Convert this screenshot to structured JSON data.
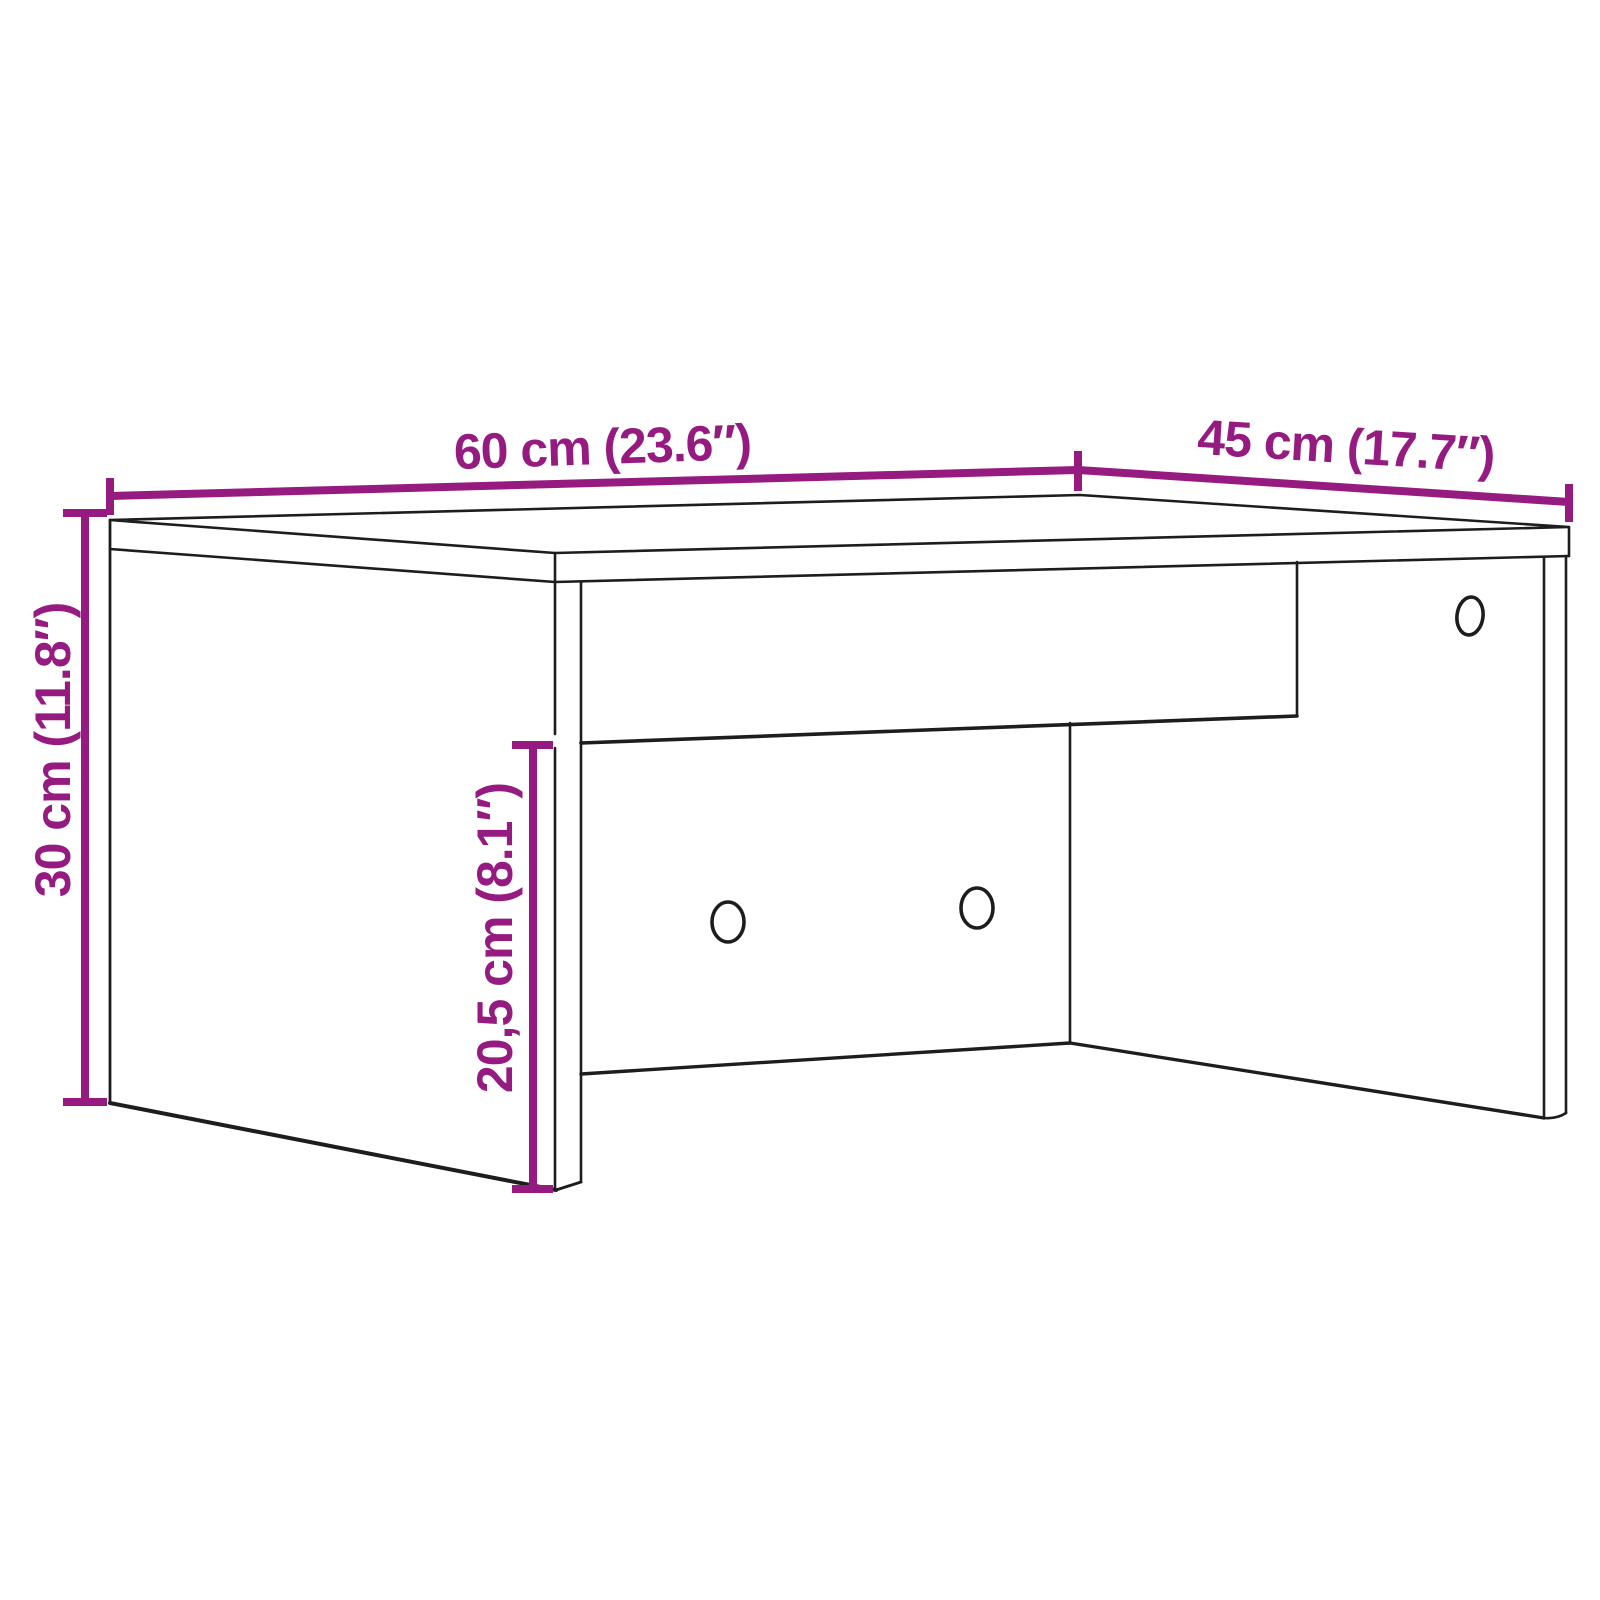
{
  "colors": {
    "dimension": "#951b81",
    "outline": "#1d1d1d",
    "background": "#ffffff"
  },
  "diagram": {
    "kind": "furniture-dimension-line-drawing",
    "dimensions": {
      "width": {
        "label": "60 cm (23.6″)",
        "value_cm": 60,
        "value_in": 23.6
      },
      "depth": {
        "label": "45 cm (17.7″)",
        "value_cm": 45,
        "value_in": 17.7
      },
      "height": {
        "label": "30 cm (11.8″)",
        "value_cm": 30,
        "value_in": 11.8
      },
      "inner_height": {
        "label": "20,5 cm (8.1″)",
        "value_cm": 20.5,
        "value_in": 8.1
      }
    }
  }
}
